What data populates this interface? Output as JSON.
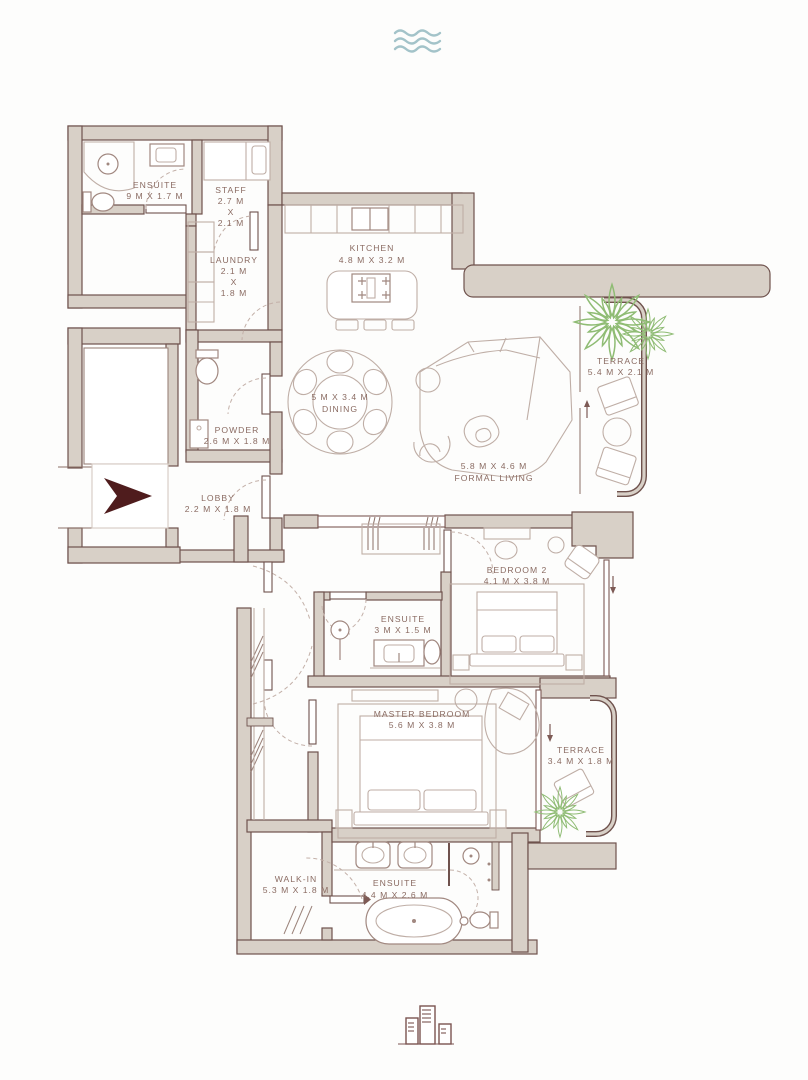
{
  "plan": {
    "rooms": {
      "ensuite_staff": {
        "label": "ENSUITE",
        "dims": "9 M X 1.7 M"
      },
      "staff": {
        "label": "STAFF",
        "dim1": "2.7 M",
        "dim2": "X",
        "dim3": "2.1 M"
      },
      "laundry": {
        "label": "LAUNDRY",
        "dim1": "2.1 M",
        "dim2": "X",
        "dim3": "1.8 M"
      },
      "kitchen": {
        "label": "KITCHEN",
        "dims": "4.8 M X 3.2 M"
      },
      "dining": {
        "dims": "5 M X 3.4 M",
        "label": "DINING"
      },
      "powder": {
        "label": "POWDER",
        "dims": "2.6 M X 1.8 M"
      },
      "lobby": {
        "label": "LOBBY",
        "dims": "2.2 M X 1.8 M"
      },
      "formal_living": {
        "dims": "5.8 M X 4.6 M",
        "label": "FORMAL LIVING"
      },
      "terrace_1": {
        "label": "TERRACE",
        "dims": "5.4 M X 2.1 M"
      },
      "bedroom_2": {
        "label": "BEDROOM 2",
        "dims": "4.1 M X 3.8 M"
      },
      "ensuite_bedroom_2": {
        "label": "ENSUITE",
        "dims": "3 M X 1.5 M"
      },
      "master_bedroom": {
        "label": "MASTER BEDROOM",
        "dims": "5.6 M X 3.8 M"
      },
      "terrace_2": {
        "label": "TERRACE",
        "dims": "3.4 M X 1.8 M"
      },
      "walk_in": {
        "label": "WALK-IN",
        "dims": "5.3 M X 1.8 M"
      },
      "ensuite_master": {
        "label": "ENSUITE",
        "dims": "4.4 M X 2.6 M"
      }
    },
    "icons": {
      "top": "waves-icon",
      "bottom": "buildings-icon",
      "entry": "entry-arrow-icon"
    },
    "colors": {
      "wall_fill": "#d8d0c7",
      "wall_line": "#6f524d",
      "furniture": "#bfaea6",
      "label_text": "#8a6b62",
      "entry_arrow": "#4f1c1d",
      "plant": "#8fbc74",
      "waves": "#a3c3c9"
    }
  }
}
